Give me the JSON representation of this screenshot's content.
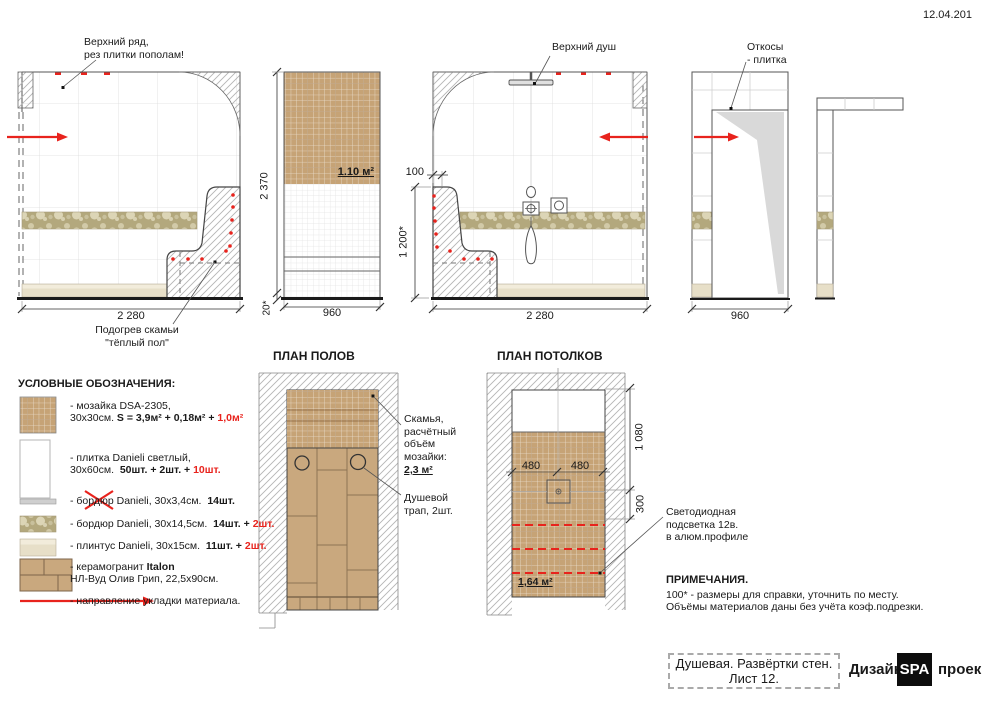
{
  "meta": {
    "date": "12.04.201"
  },
  "elevations": {
    "e1": {
      "note": "Верхний ряд,\nрез плитки пополам!",
      "dim_width": "2 280",
      "bench_note": "Подогрев скамьи\n\"тёплый пол\""
    },
    "e2": {
      "area": "1.10 м²",
      "dim_height": "2 370",
      "dim_base": "20*",
      "dim_width": "960"
    },
    "e3": {
      "note": "Верхний душ",
      "dim_bench": "100",
      "dim_height": "1 200*",
      "dim_width": "2 280"
    },
    "e4": {
      "note": "Откосы\n- плитка",
      "dim_width": "960"
    }
  },
  "floor_plan": {
    "title": "ПЛАН ПОЛОВ",
    "bench_label": "Скамья,\nрасчётный\nобъём\nмозайки:",
    "bench_area": "2,3 м²",
    "drain_label": "Душевой\nтрап, 2шт."
  },
  "ceiling_plan": {
    "title": "ПЛАН ПОТОЛКОВ",
    "dim_480_left": "480",
    "dim_480_right": "480",
    "dim_1080": "1 080",
    "dim_300": "300",
    "area": "1,64 м²",
    "led_label": "Светодиодная\nподсветка 12в.\nв алюм.профиле"
  },
  "legend": {
    "title": "УСЛОВНЫЕ ОБОЗНАЧЕНИЯ:",
    "items": [
      {
        "l1n": "- мозайка DSA-2305,",
        "l2n": "30х30см. ",
        "l2b": "S = 3,9м² + 0,18м² + ",
        "l2r": "1,0м²"
      },
      {
        "l1n": "- плитка Danieli светлый,",
        "l2n": "30х60см.  ",
        "l2b": "50шт. + 2шт. + ",
        "l2r": "10шт."
      },
      {
        "l1n": "- бордюр Danieli, 30х3,4см.  ",
        "l1b": "14шт."
      },
      {
        "l1n": "- бордюр Danieli, 30х14,5см.  ",
        "l1b": "14шт. + ",
        "l1r": "2шт."
      },
      {
        "l1n": "- плинтус Danieli, 30х15см.  ",
        "l1b": "11шт. + ",
        "l1r": "2шт."
      },
      {
        "l1n": "- керамогранит ",
        "l1b": "Italon",
        "l2n": "НЛ-Вуд Олив Грип, 22,5х90см."
      },
      {
        "l1n": "- направление укладки материала."
      }
    ]
  },
  "notes": {
    "title": "ПРИМЕЧАНИЯ.",
    "line1": "100* - размеры для справки, уточнить по месту.",
    "line2": "Объёмы материалов даны без учёта коэф.подрезки."
  },
  "title_block": {
    "line1": "Душевая. Развёртки стен.",
    "line2": "Лист 12.",
    "brand_left": "Дизайн",
    "brand_logo": "SPA",
    "brand_right": "проек"
  },
  "colors": {
    "accent_red": "#e8231d",
    "mosaic": "#c6a376",
    "plank": "#c9a87e",
    "border_tile": "#b3a87d",
    "plinth": "#e7dfc8"
  }
}
